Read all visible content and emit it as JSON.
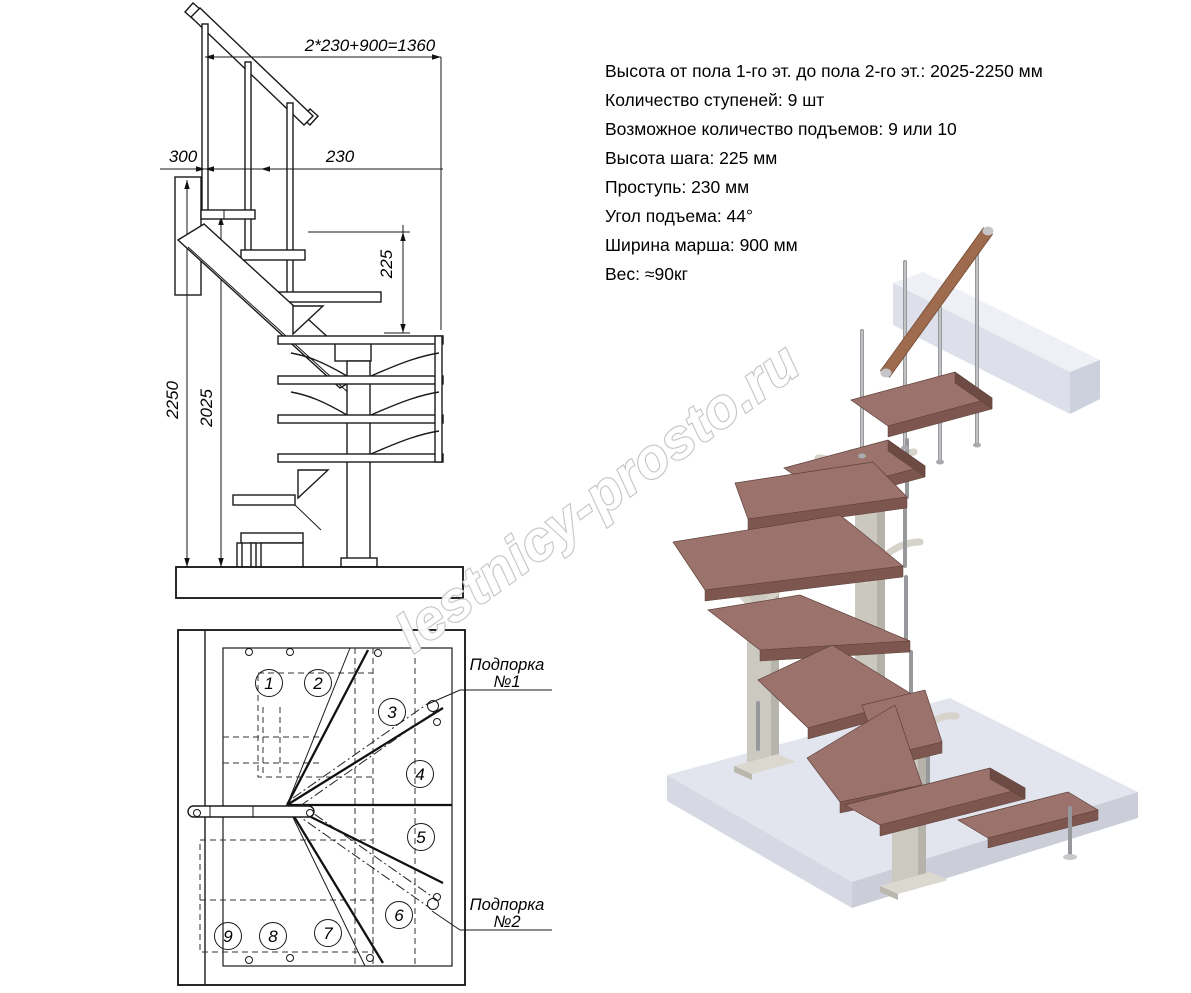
{
  "specs": {
    "lines": [
      "Высота от пола 1-го эт. до пола 2-го эт.: 2025-2250 мм",
      "Количество ступеней: 9 шт",
      "Возможное количество подъемов: 9 или 10",
      "Высота шага: 225 мм",
      "Проступь: 230 мм",
      "Угол подъема: 44°",
      "Ширина марша: 900 мм",
      "Вес: ≈90кг"
    ]
  },
  "elevation": {
    "dims": {
      "top": "2*230+900=1360",
      "d300": "300",
      "d230": "230",
      "d225": "225",
      "d2250": "2250",
      "d2025": "2025"
    }
  },
  "plan": {
    "step_numbers": [
      "1",
      "2",
      "3",
      "4",
      "5",
      "6",
      "7",
      "8",
      "9"
    ],
    "callout_1": {
      "line1": "Подпорка",
      "line2": "№1"
    },
    "callout_2": {
      "line1": "Подпорка",
      "line2": "№2"
    }
  },
  "watermark": {
    "text": "lestnicy-prosto.ru"
  },
  "colors": {
    "line": "#1a1a1a",
    "tread_top": "#9c736c",
    "tread_edge": "#7d574f",
    "metal_rod": "#97989b",
    "column": "#cbc8c0",
    "slab_top": "#e3e5ee",
    "wall_beam": "#dde0ea",
    "handrail_wood": "#9e6b4e",
    "watermark_outline": "#c5c5c5"
  }
}
